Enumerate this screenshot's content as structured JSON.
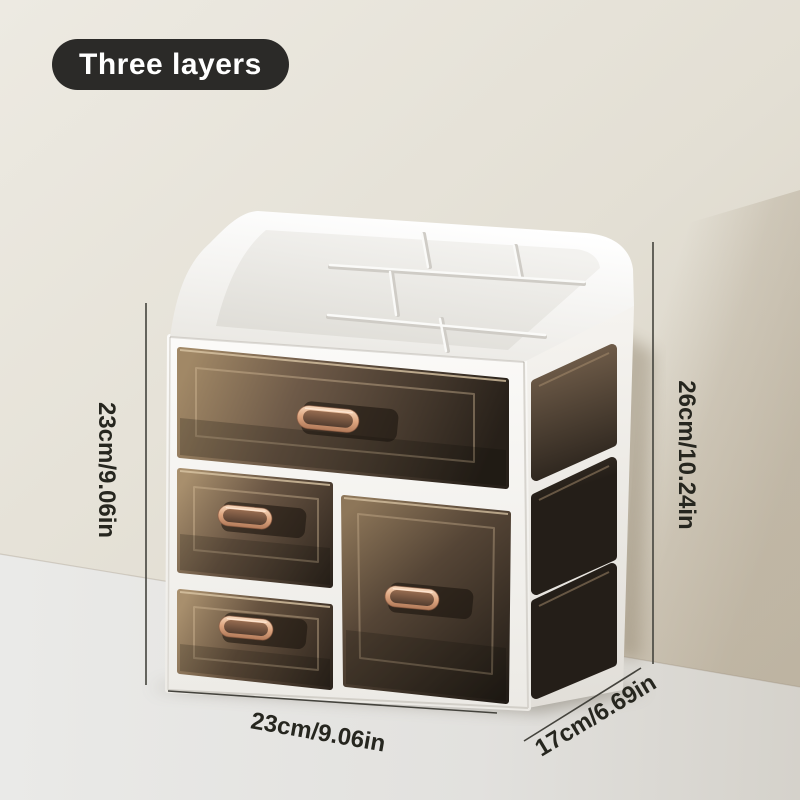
{
  "badge": {
    "label": "Three layers"
  },
  "dimensions": {
    "left_height_label": "23cm/9.06in",
    "right_height_label": "26cm/10.24in",
    "front_width_label": "23cm/9.06in",
    "side_depth_label": "17cm/6.69in"
  },
  "product": {
    "description": "White three-layer desktop cosmetic organizer: open top tray with six compartments, one full-width drawer, two small left drawers and one tall right drawer, all in translucent smoky-brown plastic with rose-gold pill handles",
    "layer_count": 3,
    "drawer_count": 4,
    "top_tray_compartments": 6,
    "colors": {
      "badge_background": "#2b2a28",
      "badge_text": "#ffffff",
      "annotation_text": "#26261f",
      "frame_white": "#f7f5f2",
      "drawer_smoke_dark": "#2c241d",
      "drawer_amber_light": "#a8906f",
      "handle_rose_gold": "#d89a78",
      "wall_beige": "#e7e3d9",
      "floor_gray": "#e5e4e2"
    }
  }
}
